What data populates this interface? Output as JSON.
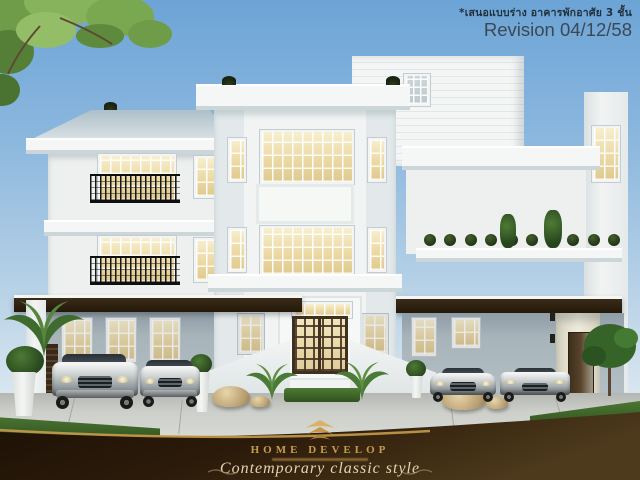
{
  "overlay": {
    "note": "*เสนอแบบร่าง อาคารพักอาศัย 3 ชั้น",
    "revision": "Revision 04/12/58"
  },
  "banner": {
    "brand": "HOME DEVELOP",
    "tagline": "Contemporary classic style"
  },
  "scene": {
    "subject": "three-storey contemporary classic house rendering",
    "storeys_shown": "3",
    "vehicle_count": "4"
  },
  "colors": {
    "sky_top": "#6ca4d6",
    "sky_horizon": "#dde9f1",
    "wall_white": "#f1f3f2",
    "wall_recessed": "#a7b4ba",
    "window_glow": "#ecd9a4",
    "canopy_brown": "#241808",
    "iron_black": "#161616",
    "banner_brown_dark": "#1c1106",
    "banner_brown_light": "#4d3a1c",
    "gold": "#c79b4e",
    "grass_green": "#4e7a35",
    "driveway_gray": "#c7c9c4",
    "finial_green": "#17230d"
  }
}
